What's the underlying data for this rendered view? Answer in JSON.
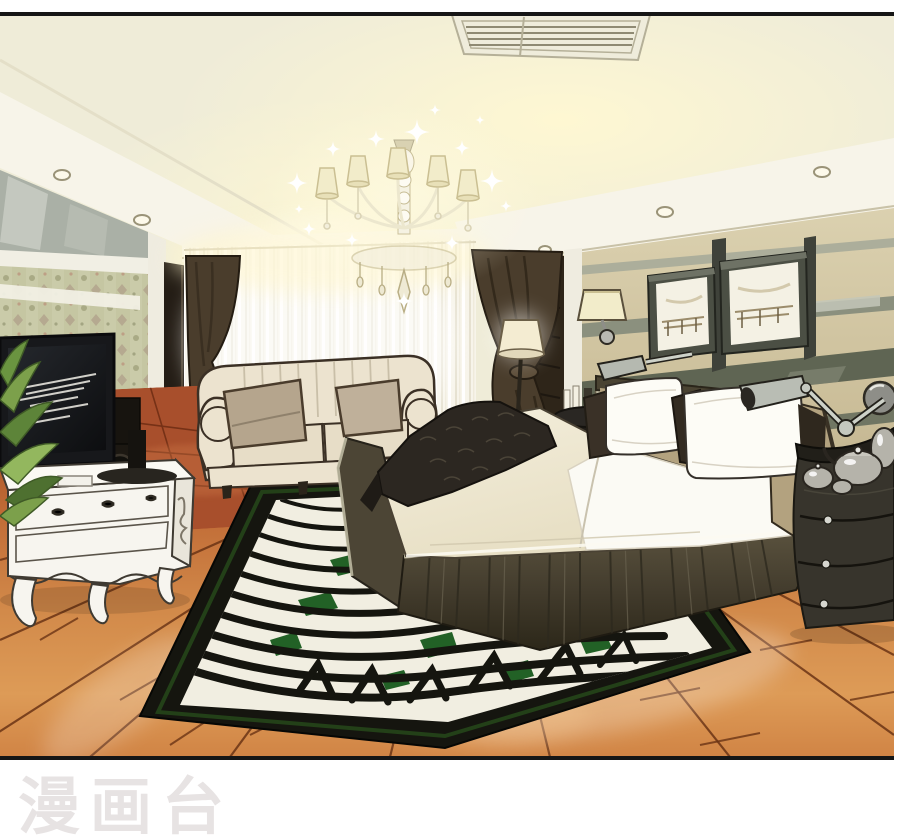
{
  "watermark": {
    "text": "漫画台"
  },
  "palette": {
    "watermark": "#e7e3e3",
    "border": "#161616",
    "ceiling": "#efecd8",
    "soffit": "#f7f4e9",
    "mirror": "#aab0a6",
    "curtain_dark": "#4a3d2c",
    "sofa": "#ece3cf",
    "cushion": "#b5a58d",
    "tv": "#17181b",
    "cabinet": "#f7f5ef",
    "sheet": "#fbfaf4",
    "throw": "#2c2721",
    "headboard": "#b3a27f",
    "rug_field": "#f1eee1",
    "rug_black": "#15150f",
    "rug_green": "#226126",
    "nightstand": "#37342c",
    "silver": "#b5b3aa",
    "chrome": "#c6c9c2",
    "plant": "#7ca04b",
    "shade_cream": "#f2ecca",
    "tile": "#a84f2c",
    "floor_seam": "#6b3415",
    "outline": "#332a1d",
    "wallpaper": "#c5c6a2"
  }
}
